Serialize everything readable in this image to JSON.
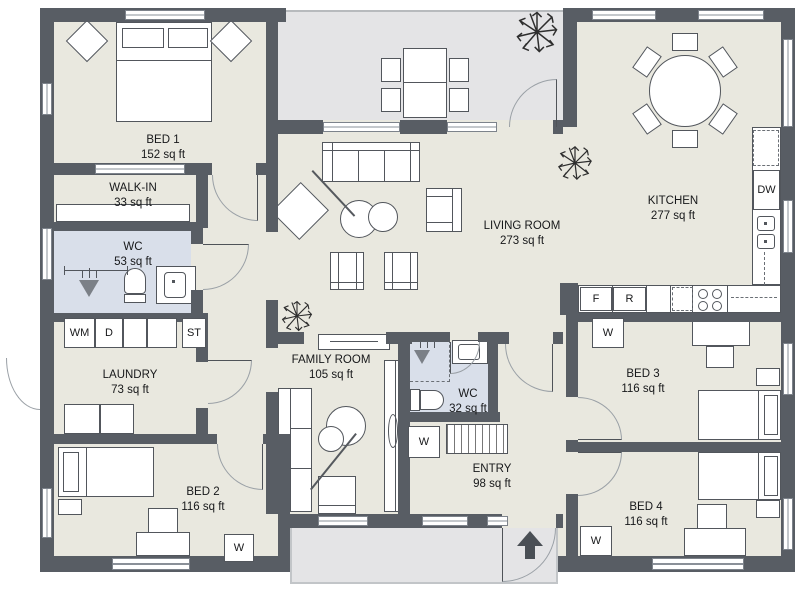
{
  "colors": {
    "wall": "#585d64",
    "floor": "#e9e8df",
    "wet_room": "#d9dfea",
    "deck": "#e4e4e6",
    "accent_dark": "#4a4f55"
  },
  "rooms": {
    "bed1": {
      "name": "BED 1",
      "area": "152 sq ft"
    },
    "walk_in": {
      "name": "WALK-IN",
      "area": "33 sq ft"
    },
    "wc1": {
      "name": "WC",
      "area": "53 sq ft"
    },
    "laundry": {
      "name": "LAUNDRY",
      "area": "73 sq ft"
    },
    "bed2": {
      "name": "BED 2",
      "area": "116 sq ft"
    },
    "family_room": {
      "name": "FAMILY ROOM",
      "area": "105 sq ft"
    },
    "living_room": {
      "name": "LIVING ROOM",
      "area": "273 sq ft"
    },
    "kitchen": {
      "name": "KITCHEN",
      "area": "277 sq ft"
    },
    "wc2": {
      "name": "WC",
      "area": "32 sq ft"
    },
    "entry": {
      "name": "ENTRY",
      "area": "98 sq ft"
    },
    "bed3": {
      "name": "BED 3",
      "area": "116 sq ft"
    },
    "bed4": {
      "name": "BED 4",
      "area": "116 sq ft"
    }
  },
  "appliances": {
    "washing_machine": "WM",
    "dryer": "D",
    "storage": "ST",
    "fridge": "F",
    "refrigerator": "R",
    "dishwasher": "DW",
    "wardrobe": "W"
  }
}
